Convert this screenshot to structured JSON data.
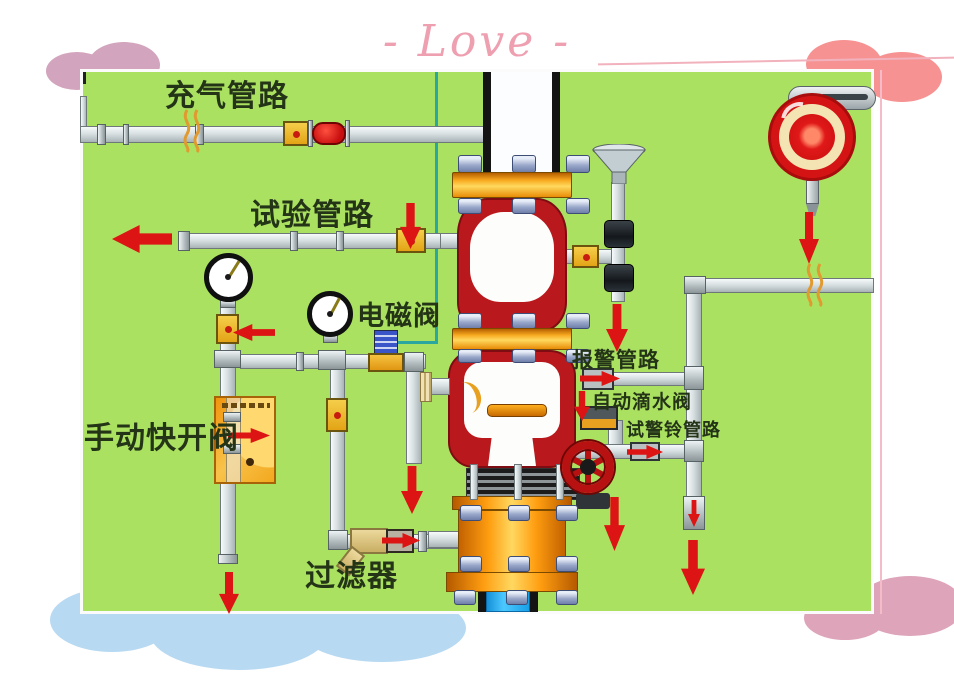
{
  "slide": {
    "header_text": "- Love -",
    "header_color": "#ee9fb0",
    "decor": {
      "top_left_cloud": "#d2a4bd",
      "top_right_cloud": "#f69292",
      "bottom_left_cloud": "#b7d9f2",
      "bottom_right_cloud": "#dda4ba"
    }
  },
  "diagram": {
    "background_color": "#abe161",
    "pipe_color": "#d8e0e2",
    "valve_body_color": "#b9191d",
    "flange_color": "#f7a81f",
    "flow_arrow_color": "#dd1414",
    "control_line_color": "#2aa79f",
    "water_supply_color": "#2ab2f2",
    "gong_colors": {
      "outer_ring": "#d41414",
      "mid_ring": "#f4e4b4",
      "center": "#e82020"
    },
    "labels": {
      "charging_line": "充气管路",
      "test_line": "试验管路",
      "solenoid_valve": "电磁阀",
      "manual_quick_open_valve": "手动快开阀",
      "filter": "过滤器",
      "alarm_line": "报警管路",
      "auto_drip_valve": "自动滴水阀",
      "alarm_bell_test_line": "试警铃管路"
    }
  }
}
